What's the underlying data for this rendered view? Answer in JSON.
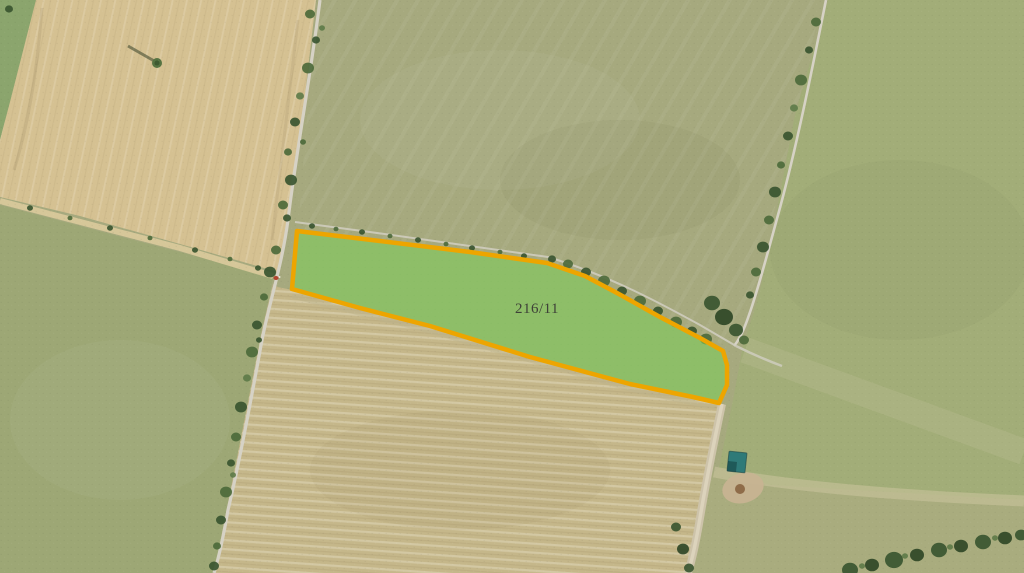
{
  "map": {
    "parcel": {
      "id_label": "216/11",
      "fill_color": "rgba(124,205,88,0.58)",
      "outline_color": "#eda500",
      "label_color": "#3e4138"
    },
    "terrain_colors": {
      "base_pasture": "#a6a97e",
      "field_top_right": "#a2ad78",
      "field_bottom_right": "#a9ac7e",
      "field_bottom_left": "#9da775",
      "field_wedge_top_left": "#8ba56d",
      "wheat_field": "#d5c192",
      "stubble_field": "#c5b78a",
      "road": "#d6d2c5",
      "farm_track": "#cfccbe",
      "dirt_track": "#cdc3aa"
    },
    "features": {
      "shed_color": "#2f7a78",
      "vehicle_color": "#b1452f"
    }
  }
}
